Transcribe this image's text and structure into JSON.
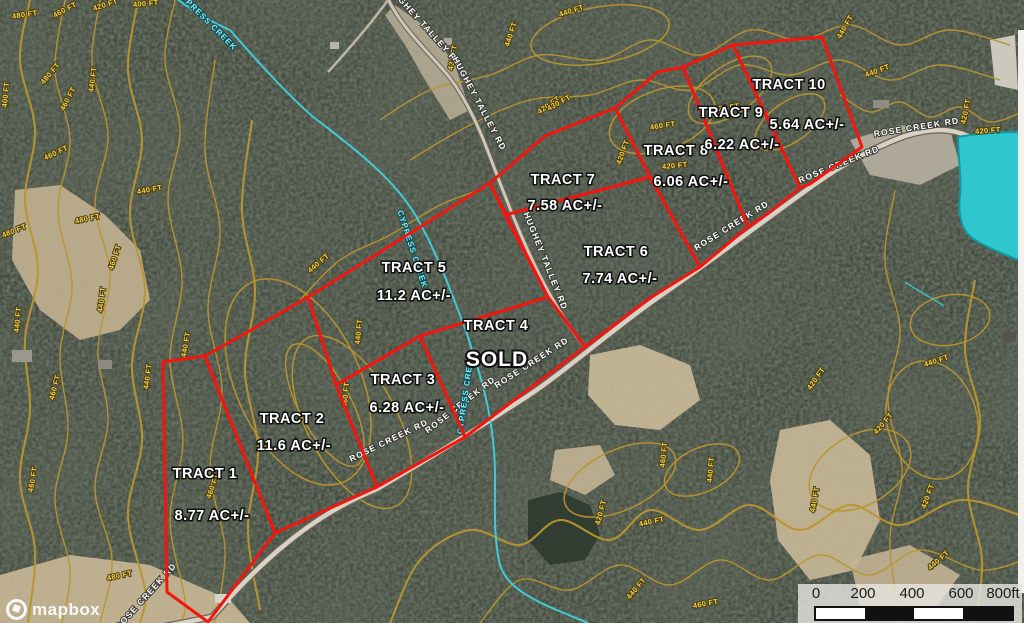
{
  "map": {
    "colors": {
      "tract_outline": "#f3160f",
      "contour": "#b9952e",
      "contour_label": "#f2d24b",
      "creek": "#3fd2de",
      "pond": "#2fc7cd",
      "road_fill": "#d8d2c4",
      "field_tan": "#c7b593"
    },
    "tracts": [
      {
        "name": "TRACT 1",
        "area": "8.77 AC+/-",
        "points": "163,362 205,356 275,533 208,622 167,592",
        "name_pos": [
          205,
          478
        ],
        "area_pos": [
          212,
          520
        ]
      },
      {
        "name": "TRACT 2",
        "area": "11.6 AC+/-",
        "points": "205,356 253,329 308,297 336,385 377,487 275,533",
        "name_pos": [
          292,
          423
        ],
        "area_pos": [
          294,
          450
        ]
      },
      {
        "name": "TRACT 3",
        "area": "6.28 AC+/-",
        "points": "336,385 420,336 465,437 377,487",
        "name_pos": [
          403,
          384
        ],
        "area_pos": [
          407,
          412
        ]
      },
      {
        "name": "TRACT 4",
        "area": "",
        "sold_label": "SOLD",
        "points": "420,336 548,297 585,347 465,437",
        "name_pos": [
          496,
          330
        ],
        "area_pos": [
          497,
          366
        ]
      },
      {
        "name": "TRACT 5",
        "area": "11.2 AC+/-",
        "points": "308,297 350,271 490,183 548,297 420,336 336,385",
        "name_pos": [
          414,
          272
        ],
        "area_pos": [
          414,
          300
        ]
      },
      {
        "name": "TRACT 6",
        "area": "7.74 AC+/-",
        "points": "505,215 650,177 700,267 650,298 585,347 548,297",
        "name_pos": [
          616,
          256
        ],
        "area_pos": [
          620,
          283
        ]
      },
      {
        "name": "TRACT 7",
        "area": "7.58 AC+/-",
        "points": "490,183 545,136 615,108 650,177 505,215",
        "name_pos": [
          563,
          184
        ],
        "area_pos": [
          565,
          210
        ]
      },
      {
        "name": "TRACT 8",
        "area": "6.06 AC+/-",
        "points": "615,108 658,72 683,67 748,227 700,267 650,177",
        "name_pos": [
          676,
          155
        ],
        "area_pos": [
          691,
          186
        ]
      },
      {
        "name": "TRACT 9",
        "area": "6.22 AC+/-",
        "points": "683,67 733,45 800,188 770,212 748,227",
        "name_pos": [
          731,
          117
        ],
        "area_pos": [
          742,
          149
        ]
      },
      {
        "name": "TRACT 10",
        "area": "5.64 AC+/-",
        "points": "733,45 822,37 862,147 810,184 800,188",
        "name_pos": [
          789,
          89
        ],
        "area_pos": [
          807,
          129
        ]
      }
    ],
    "roads": [
      {
        "name": "ROSE CREEK RD",
        "labels": [
          [
            148,
            598,
            -48
          ],
          [
            390,
            443,
            -26
          ],
          [
            462,
            407,
            -38
          ],
          [
            533,
            365,
            -33
          ],
          [
            733,
            228,
            -32
          ],
          [
            840,
            167,
            -22
          ],
          [
            917,
            130,
            -9
          ]
        ]
      },
      {
        "name": "HUGHEY TALLEY RD",
        "labels": [
          [
            423,
            28,
            48
          ],
          [
            477,
            105,
            62
          ],
          [
            543,
            262,
            68
          ]
        ]
      }
    ],
    "creek": {
      "name": "CYPRESS CREEK",
      "labels": [
        [
          205,
          22,
          45
        ],
        [
          410,
          250,
          72
        ],
        [
          468,
          394,
          -82
        ]
      ]
    },
    "contour_labels": [
      [
        25,
        17,
        -8,
        "480 FT"
      ],
      [
        66,
        12,
        -28,
        "460 FT"
      ],
      [
        106,
        7,
        -18,
        "420 FT"
      ],
      [
        146,
        6,
        -5,
        "400 FT"
      ],
      [
        95,
        80,
        -82,
        "440 FT"
      ],
      [
        52,
        75,
        -50,
        "480 FT"
      ],
      [
        8,
        95,
        -85,
        "400 FT"
      ],
      [
        70,
        100,
        -62,
        "460 FT"
      ],
      [
        57,
        155,
        -25,
        "460 FT"
      ],
      [
        150,
        192,
        -10,
        "440 FT"
      ],
      [
        88,
        221,
        -12,
        "480 FT"
      ],
      [
        15,
        233,
        -22,
        "480 FT"
      ],
      [
        117,
        258,
        -72,
        "460 FT"
      ],
      [
        104,
        300,
        -82,
        "440 FT"
      ],
      [
        20,
        320,
        -85,
        "440 FT"
      ],
      [
        150,
        377,
        -82,
        "440 FT"
      ],
      [
        57,
        388,
        -75,
        "460 FT"
      ],
      [
        120,
        578,
        -12,
        "480 FT"
      ],
      [
        35,
        480,
        -80,
        "460 FT"
      ],
      [
        188,
        345,
        -80,
        "440 FT"
      ],
      [
        215,
        487,
        -70,
        "460 FT"
      ],
      [
        361,
        332,
        -85,
        "440 FT"
      ],
      [
        348,
        395,
        -85,
        "460 FT"
      ],
      [
        320,
        265,
        -40,
        "440 FT"
      ],
      [
        550,
        107,
        -35,
        "420 FT"
      ],
      [
        663,
        128,
        -8,
        "460 FT"
      ],
      [
        727,
        110,
        -8,
        "420 FT"
      ],
      [
        625,
        153,
        -70,
        "420 FT"
      ],
      [
        675,
        168,
        -5,
        "420 FT"
      ],
      [
        603,
        513,
        -75,
        "420 FT"
      ],
      [
        652,
        524,
        -12,
        "440 FT"
      ],
      [
        666,
        455,
        -85,
        "460 FT"
      ],
      [
        713,
        470,
        -85,
        "440 FT"
      ],
      [
        706,
        606,
        -10,
        "460 FT"
      ],
      [
        638,
        590,
        -50,
        "440 FT"
      ],
      [
        818,
        380,
        -55,
        "420 FT"
      ],
      [
        937,
        363,
        -18,
        "440 FT"
      ],
      [
        885,
        425,
        -50,
        "420 FT"
      ],
      [
        817,
        500,
        -80,
        "440 FT"
      ],
      [
        940,
        562,
        -40,
        "440 FT"
      ],
      [
        930,
        497,
        -70,
        "420 FT"
      ],
      [
        878,
        73,
        -20,
        "440 FT"
      ],
      [
        968,
        112,
        -78,
        "420 FT"
      ],
      [
        988,
        133,
        -4,
        "420 FT"
      ],
      [
        455,
        58,
        -80,
        "430 FT"
      ],
      [
        513,
        35,
        -72,
        "440 FT"
      ],
      [
        572,
        13,
        -18,
        "440 FT"
      ],
      [
        560,
        105,
        -28,
        "430 FT"
      ],
      [
        847,
        28,
        -60,
        "440 FT"
      ]
    ]
  },
  "scale_bar": {
    "ticks": [
      "0",
      "200",
      "400",
      "600",
      "800ft"
    ]
  },
  "attribution": {
    "logo_text": "mapbox"
  }
}
